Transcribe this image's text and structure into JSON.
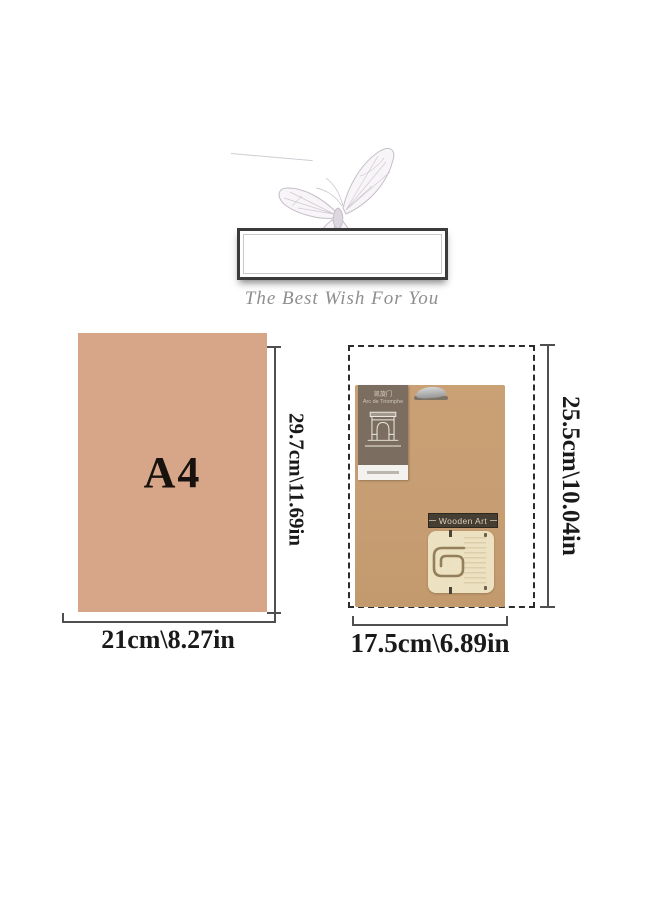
{
  "header": {
    "tagline": "The Best Wish For You"
  },
  "a4": {
    "label": "A4",
    "height_label": "29.7cm\\11.69in",
    "width_label": "21cm\\8.27in"
  },
  "product": {
    "banner_text": "Wooden Art",
    "height_label": "25.5cm\\10.04in",
    "width_label": "17.5cm\\6.89in",
    "package_label": {
      "title_cn": "凯旋门",
      "title_en": "Arc de Triomphe"
    }
  },
  "icons": {
    "butterfly": "butterfly-sketch",
    "hang_hole": "euro-hang-hole",
    "arc_monument": "arc-de-triomphe-drawing",
    "spiral_cutout": "wood-spiral-cutout"
  },
  "colors": {
    "a4_fill": "#d7a688",
    "kraft": "#c79e73",
    "label_taupe": "#7b6e60",
    "banner_dark": "#463d33",
    "wood_cream": "#ece1c1",
    "dimension_line": "#4f4f4f",
    "dimension_text": "#1a1a1a",
    "tagline_gray": "#8e8e8e"
  }
}
